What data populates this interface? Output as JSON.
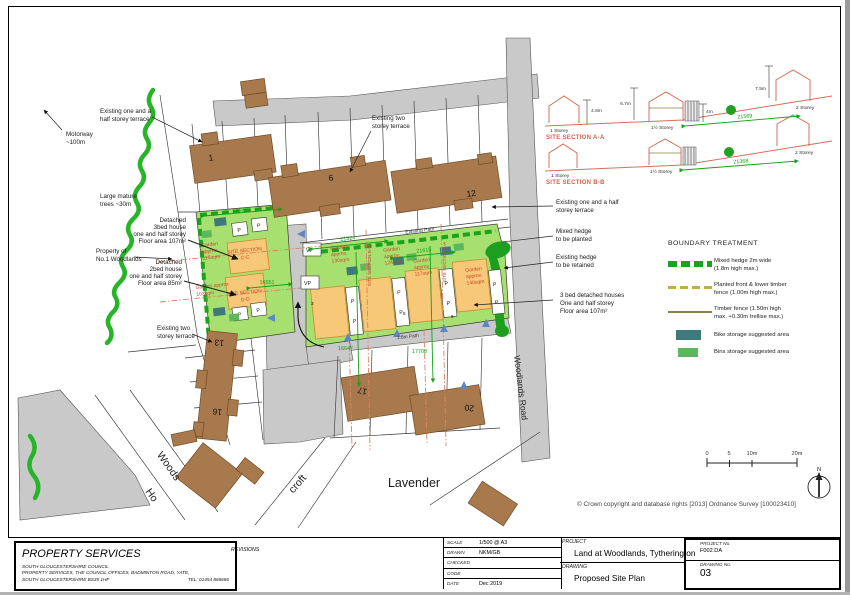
{
  "sheet": {
    "copyright": "© Crown copyright and database rights [2013] Ordnance Survey [100023410]"
  },
  "titleblock": {
    "company": "PROPERTY SERVICES",
    "address1": "SOUTH GLOUCESTERSHIRE COUNCIL",
    "address2": "PROPERTY SERVICES, THE COUNCIL OFFICES, BADMINTON ROAD, YATE,",
    "address3": "SOUTH GLOUCESTERSHIRE BS35 1HF",
    "tel": "TEL: 01454 868686",
    "revisions_label": "REVISIONS",
    "fields": [
      {
        "label": "SCALE",
        "value": "1/500 @ A3"
      },
      {
        "label": "DRAWN",
        "value": "NKM/GB"
      },
      {
        "label": "CHECKED",
        "value": ""
      },
      {
        "label": "CODE",
        "value": ""
      },
      {
        "label": "DATE",
        "value": "Dec 2019"
      }
    ],
    "project_label": "PROJECT",
    "project": "Land at Woodlands, Tytherington",
    "drawing_label": "DRAWING",
    "drawing": "Proposed Site Plan",
    "project_no_label": "PROJECT No.",
    "project_no": "F002.DA",
    "drawing_no_label": "DRAWING No.",
    "drawing_no": "03"
  },
  "legend": {
    "title": "BOUNDARY TREATMENT",
    "items": [
      {
        "line1": "Mixed hedge 2m wide",
        "line2": "(1.8m high max.)"
      },
      {
        "line1": "Planted front & lower timber",
        "line2": "fence (1.00m high max.)"
      },
      {
        "line1": "Timber fence (1.50m high",
        "line2": "max. +0.30m trellise max.)"
      },
      {
        "line1": "Bike storage suggested area",
        "line2": ""
      },
      {
        "line1": "Bins storage suggested area",
        "line2": ""
      }
    ]
  },
  "site_sections": {
    "a": {
      "title": "SITE SECTION A-A",
      "s1": "1 Storey",
      "s15": "1½ Storey",
      "s2": "2 Storey",
      "h1": "4.8m",
      "h2": "6.7m",
      "h3": "4m",
      "h4": "7.5m",
      "dim": "21569"
    },
    "b": {
      "title": "SITE SECTION B-B",
      "s1": "1 Storey",
      "s15": "1½ Storey",
      "s2": "2 Storey",
      "dim": "21368"
    }
  },
  "scalebar": {
    "t0": "0",
    "t5": "5",
    "t10": "10m",
    "t20": "20m",
    "north": "N"
  },
  "plan": {
    "labels": {
      "woodlands_road": "Woodlands Road",
      "lavender": "Lavender",
      "existing_path": "Existing Path",
      "path18": "1.8m Path",
      "woods1": "Woods",
      "woods2": "Ho",
      "croft": "croft"
    },
    "p": "P",
    "vp": "VP",
    "numbers": {
      "n1": "1",
      "n6": "6",
      "n12": "12",
      "n13": "13",
      "n16": "16",
      "n17": "17",
      "n20": "20",
      "p3": "3",
      "p5": "5",
      "p6": "6"
    },
    "dims": {
      "d1": "14680",
      "d2": "21324",
      "d3": "21615",
      "d4": "16551",
      "d5": "16647",
      "d6": "17708"
    },
    "gardens": [
      {
        "l1": "Garden",
        "l2": "approx",
        "l3": "115sqm"
      },
      {
        "l1": "Garden approx",
        "l2": "103sqm",
        "l3": ""
      },
      {
        "l1": "Garden",
        "l2": "approx.",
        "l3": "130sqm"
      },
      {
        "l1": "Garden",
        "l2": "approx.",
        "l3": "124sqm"
      },
      {
        "l1": "Garden",
        "l2": "approx.",
        "l3": "117sqm"
      },
      {
        "l1": "Garden",
        "l2": "approx.",
        "l3": "140sqm"
      }
    ],
    "section_marks": {
      "cc1": "SITE SECTION",
      "cc2": "C-C",
      "dd1": "SITE SECTION",
      "dd2": "D-D",
      "bb": "SITE SECTION B-B",
      "aa": "SITE SECTION A-A"
    },
    "annotations": [
      {
        "lines": [
          "Existing one and a",
          "half storey terrace"
        ]
      },
      {
        "lines": [
          "Motorway",
          "~100m"
        ]
      },
      {
        "lines": [
          "Large mature",
          "trees ~30m"
        ]
      },
      {
        "lines": [
          "Property of",
          "No.1 Woodlands"
        ]
      },
      {
        "lines": [
          "Detached",
          "3bed house",
          "one and half storey",
          "Floor area 107m²"
        ]
      },
      {
        "lines": [
          "Detached",
          "2bed house",
          "one and half storey",
          "Floor area 85m²"
        ]
      },
      {
        "lines": [
          "Existing two",
          "storey terrace"
        ]
      },
      {
        "lines": [
          "Existing two",
          "storey terrace"
        ]
      },
      {
        "lines": [
          "Existing one and a half",
          "storey terrace"
        ]
      },
      {
        "lines": [
          "Mixed hedge",
          "to be planted"
        ]
      },
      {
        "lines": [
          "Existing hedge",
          "to be retained"
        ]
      },
      {
        "lines": [
          "3 bed detached houses",
          "One and half storey",
          "Floor area 107m²"
        ]
      }
    ]
  },
  "colors": {
    "garden": "#a8e070",
    "hedge": "#1ba41b",
    "bike": "#40797c",
    "bins": "#5db85d",
    "new_house": "#f7c877",
    "existing_building": "#a8794d",
    "road": "#c9c9c9",
    "section_line": "#d4705a",
    "dim_green": "#18a018",
    "red_text": "#c8442c"
  }
}
